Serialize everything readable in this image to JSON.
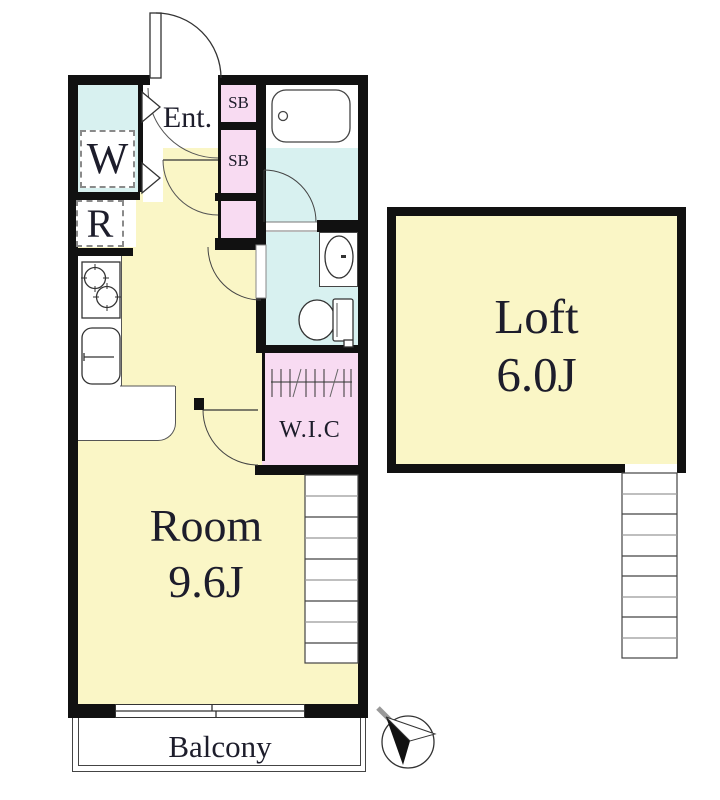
{
  "colors": {
    "floor": "#FAF6C6",
    "wet": "#D8F1F0",
    "closet": "#F8DBF2",
    "wall": "#111111",
    "line": "#333333",
    "text": "#1D1D2B"
  },
  "labels": {
    "entrance": "Ent.",
    "washer": "W",
    "fridge": "R",
    "shoebox_upper": "SB",
    "shoebox_lower": "SB",
    "wic": "W.I.C",
    "room_name": "Room",
    "room_size": "9.6J",
    "loft_name": "Loft",
    "loft_size": "6.0J",
    "balcony": "Balcony"
  },
  "icons": {
    "compass": "north-arrow"
  }
}
